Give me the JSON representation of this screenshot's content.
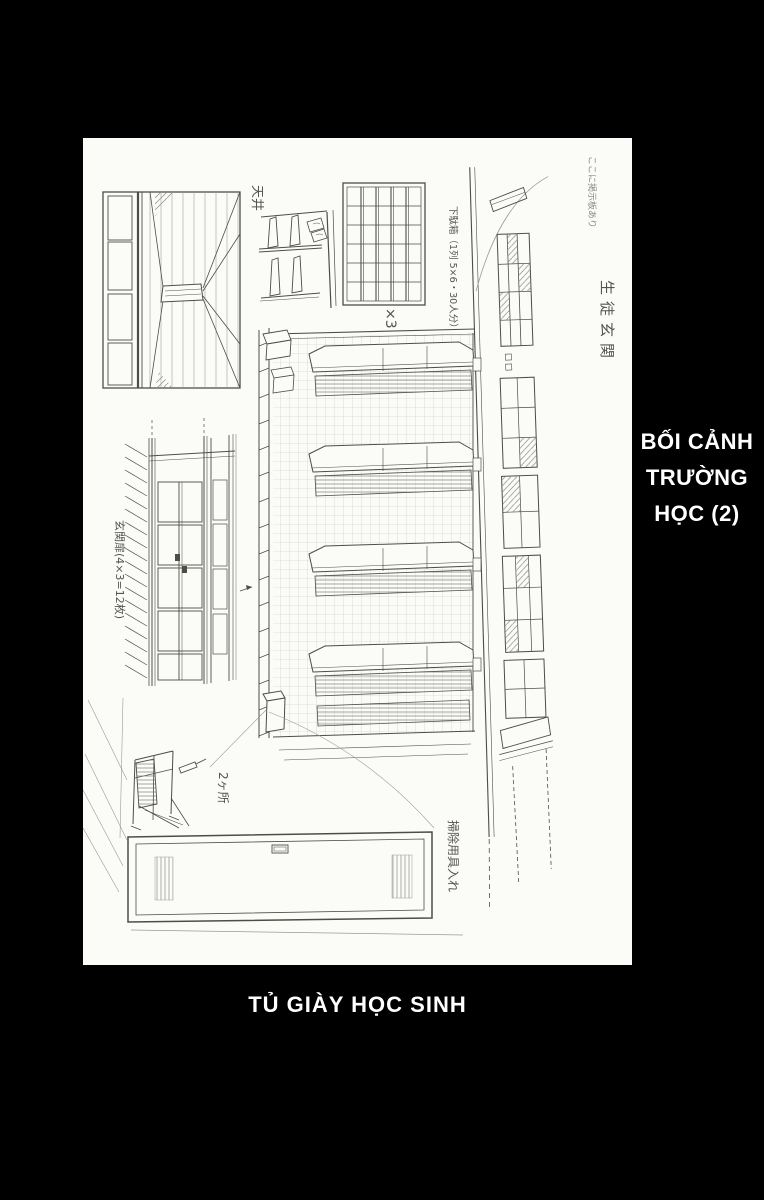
{
  "scan": {
    "background_color": "#000000",
    "paper_color": "#fbfbf8",
    "pencil_color": "#4d4d48"
  },
  "side_title": {
    "lines": [
      "BỐI CẢNH",
      "TRƯỜNG",
      "HỌC (2)"
    ],
    "color": "#ffffff"
  },
  "caption": {
    "text": "TỦ GIÀY HỌC SINH",
    "color": "#ffffff"
  },
  "sketch": {
    "annotations": {
      "ceiling": "天井",
      "shoe_cabinet": "下駄箱（1列 5×6・30人分）",
      "multiplier": "×3",
      "student_entrance": "生徒玄関",
      "entrance_doors": "玄関扉(4×3=12枚)",
      "two_places": "2ヶ所",
      "cleaning_supplies": "掃除用具入れ",
      "handwritten_note": "ここに掲示板あり"
    }
  }
}
